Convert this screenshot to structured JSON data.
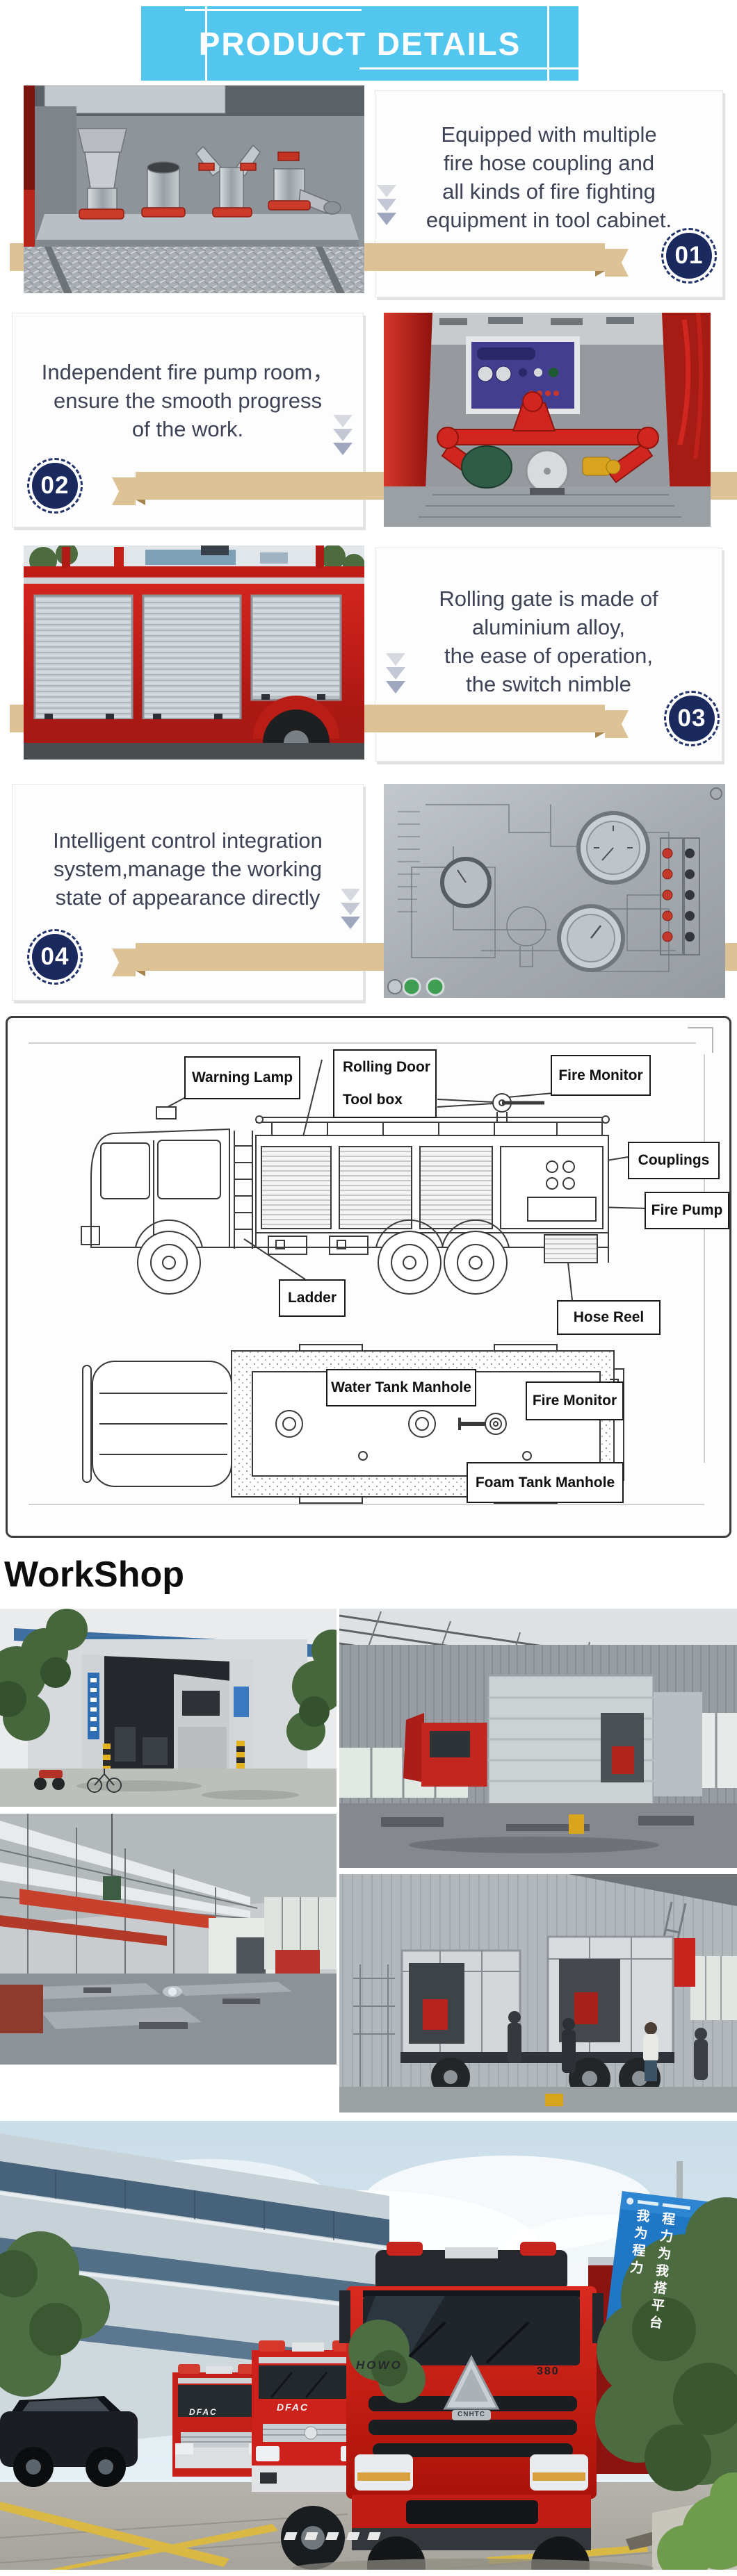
{
  "banner": {
    "title": "PRODUCT DETAILS"
  },
  "sections": [
    {
      "number": "01",
      "side": "image-left",
      "lines": [
        "Equipped with multiple",
        "fire hose coupling and",
        "all kinds of fire fighting",
        "equipment in tool cabinet."
      ],
      "photo_alt": "fire hose couplings with red bases inside tool cabinet"
    },
    {
      "number": "02",
      "side": "image-right",
      "lines": [
        "Independent fire pump room，",
        "ensure the smooth progress",
        "of the work."
      ],
      "photo_alt": "independent fire pump room with red pipes and control panel"
    },
    {
      "number": "03",
      "side": "image-left",
      "lines": [
        "Rolling gate is made of",
        "aluminium alloy,",
        "the ease of operation,",
        "the switch nimble"
      ],
      "photo_alt": "red fire truck side with aluminium rolling gates"
    },
    {
      "number": "04",
      "side": "image-right",
      "lines": [
        "Intelligent control integration",
        "system,manage the working",
        "state of appearance directly"
      ],
      "photo_alt": "stainless control integration panel with gauges"
    }
  ],
  "diagram": {
    "side_view_labels": {
      "warning_lamp": "Warning Lamp",
      "rolling_door": "Rolling Door",
      "tool_box": "Tool box",
      "fire_monitor": "Fire Monitor",
      "couplings": "Couplings",
      "fire_pump": "Fire Pump",
      "ladder": "Ladder",
      "hose_reel": "Hose Reel"
    },
    "top_view_labels": {
      "water_tank_manhole": "Water Tank Manhole",
      "fire_monitor": "Fire Monitor",
      "foam_tank_manhole": "Foam Tank Manhole"
    }
  },
  "workshop": {
    "heading": "WorkShop"
  },
  "bottom_photo": {
    "truck_brand": "HOWO",
    "truck_model": "380",
    "emblem_text": "CNHTC",
    "small_truck_brand": "DFAC",
    "sign_column_1": "程力为我搭平台",
    "sign_column_2": "我为程力"
  },
  "colors": {
    "banner_bg": "#53c6ef",
    "ribbon": "#dcc294",
    "ribbon_fold": "#a8854f",
    "badge_navy": "#1b2a5e",
    "body_text": "#3d4254",
    "diagram_border": "#3c3c3c"
  }
}
